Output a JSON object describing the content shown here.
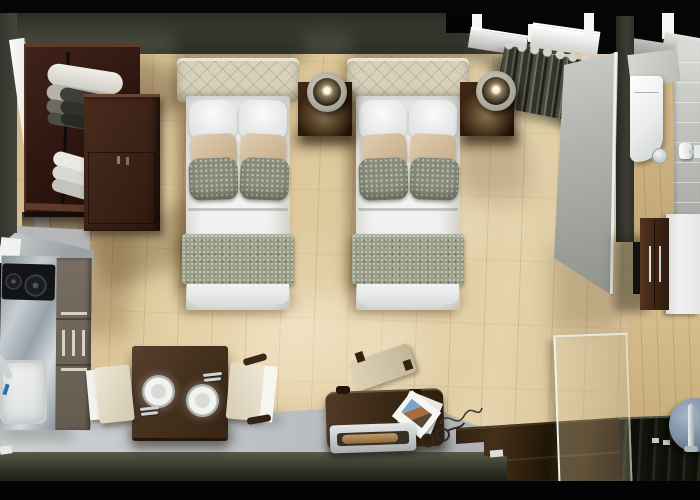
{
  "meta": {
    "label": "Top-down 3D render of a hotel twin studio room",
    "width_px": 700,
    "height_px": 500
  },
  "scene": {
    "areas": [
      {
        "id": "sleeping-area",
        "label": "twin beds with nightstands and lamps"
      },
      {
        "id": "wardrobe-area",
        "label": "open wardrobe with folded and hanging clothes and dresser"
      },
      {
        "id": "kitchenette",
        "label": "steel counter with two-burner cooktop, sink and cabinet drawers"
      },
      {
        "id": "dining-area",
        "label": "square table with two plates, cutlery and two cream chairs"
      },
      {
        "id": "bench-area",
        "label": "luggage bench with chair, brochure, tray and glasses"
      },
      {
        "id": "bathroom",
        "label": "toilet, paper holder, vanity cabinet, shower tray, glass panel, round basin"
      },
      {
        "id": "window-area",
        "label": "window sills and draped gray curtain"
      },
      {
        "id": "entry-walkway",
        "label": "gray tiled walkway and dark wood platform"
      }
    ],
    "objects": [
      "bed-1",
      "bed-2",
      "headboard",
      "white-pillows",
      "tan-pillows",
      "gray-damask-pillows",
      "bed-runner",
      "nightstand-1",
      "nightstand-2",
      "lamp-1",
      "lamp-2",
      "wardrobe",
      "clothes-rail",
      "folded-clothes",
      "hanging-clothes",
      "dresser",
      "kitchen-counter",
      "cooktop",
      "kitchen-sink",
      "kitchen-cabinets",
      "dining-table",
      "plate-1",
      "plate-2",
      "cutlery",
      "chair-left",
      "chair-right",
      "bench",
      "desk-chair",
      "brochure",
      "tray",
      "eyeglasses",
      "cable",
      "curtain",
      "window-sills",
      "partition-wall",
      "toilet",
      "toilet-paper-holder",
      "cup",
      "vanity-counter",
      "vanity-cabinet",
      "shower-glass",
      "shower-tray",
      "drain-fittings",
      "round-basin",
      "faucet"
    ],
    "palette": {
      "frame_black": "#060606",
      "wall_olive": "#45463b",
      "floor_wood": "#dcc59a",
      "floor_gray": "#c3c7c9",
      "cut_band": "#3b3d32",
      "wardrobe_brown": "#351d13",
      "dresser_brown": "#4a2c1e",
      "headboard_cream": "#d7d1bc",
      "bedding_white": "#f2f4f3",
      "pillow_tan": "#d2bc9c",
      "pillow_gray": "#878b7b",
      "runner_green_gray": "#989e87",
      "nightstand_brown": "#33200f",
      "lamp_shade": "#c2beb1",
      "curtain_gray_green": "#474a3f",
      "partition_gray": "#b0b2ad",
      "counter_steel": "#a8b1b8",
      "cooktop_black": "#121417",
      "table_brown": "#46311f",
      "chair_cream": "#e5ddc9",
      "bench_brown": "#3b2917",
      "platform_brown": "#2a1c0c",
      "shower_tray_black": "#12140c",
      "basin_blue_gray": "#7f92a6",
      "toilet_white": "#f2f4f3",
      "vanity_brown": "#3a2313",
      "vanity_counter_white": "#eef0ef"
    }
  }
}
